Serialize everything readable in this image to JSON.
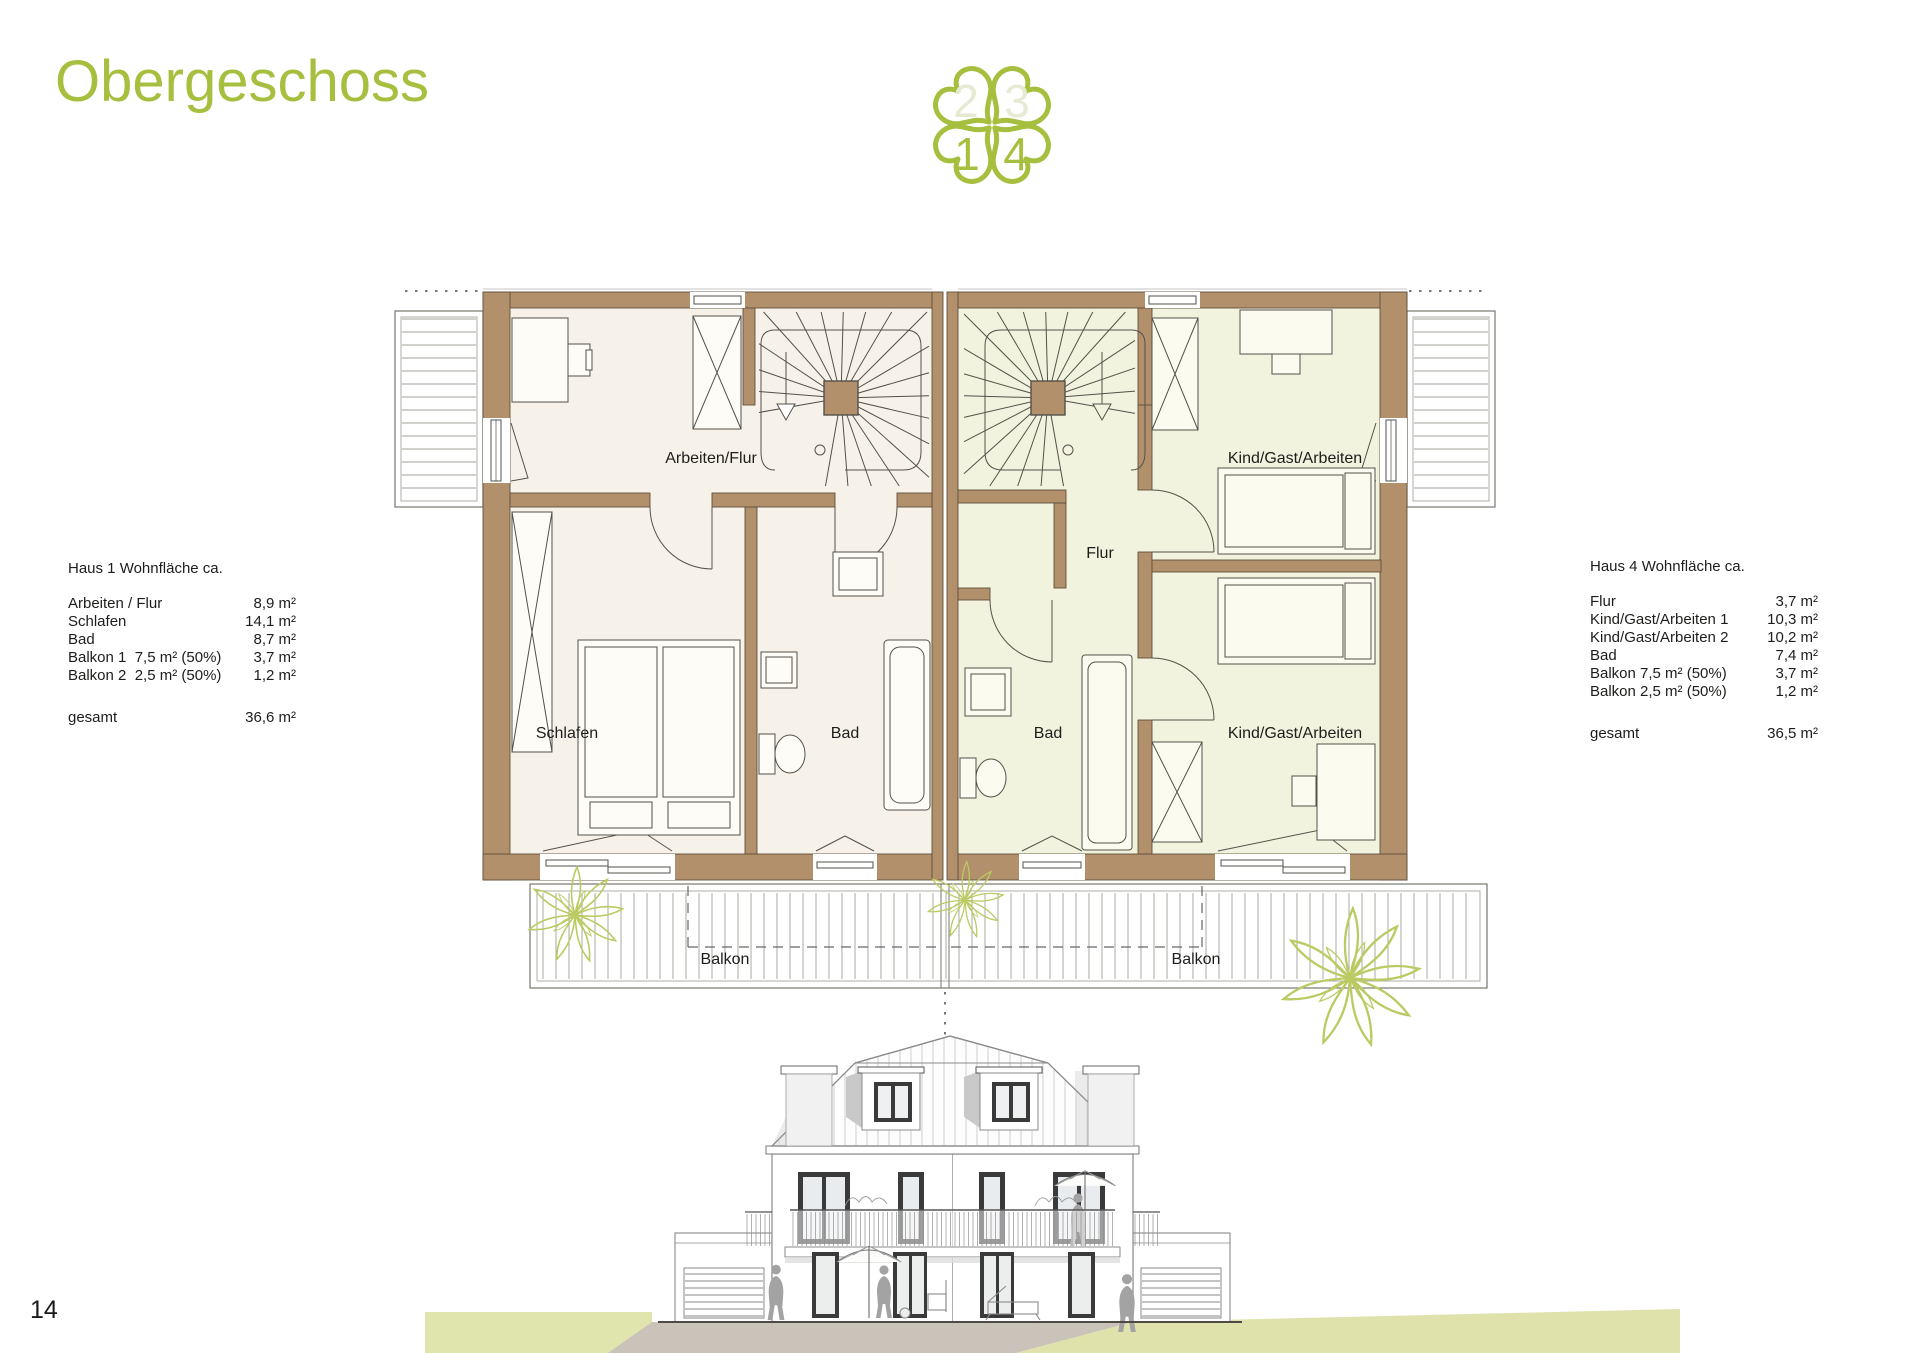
{
  "page": {
    "title": "Obergeschoss",
    "page_number": "14"
  },
  "logo": {
    "top_left": "2",
    "top_right": "3",
    "bottom_left": "1",
    "bottom_right": "4"
  },
  "tables": {
    "haus1": {
      "title": "Haus 1 Wohnfläche ca.",
      "rows": [
        {
          "label": "Arbeiten / Flur",
          "value": "8,9 m²"
        },
        {
          "label": "Schlafen",
          "value": "14,1 m²"
        },
        {
          "label": "Bad",
          "value": "8,7 m²"
        },
        {
          "label": "Balkon 1  7,5 m² (50%)",
          "value": "3,7 m²"
        },
        {
          "label": "Balkon 2  2,5 m² (50%)",
          "value": "1,2 m²"
        }
      ],
      "total_label": "gesamt",
      "total_value": "36,6 m²"
    },
    "haus4": {
      "title": "Haus 4 Wohnfläche ca.",
      "rows": [
        {
          "label": "Flur",
          "value": "3,7 m²"
        },
        {
          "label": "Kind/Gast/Arbeiten 1",
          "value": "10,3 m²"
        },
        {
          "label": "Kind/Gast/Arbeiten 2",
          "value": "10,2 m²"
        },
        {
          "label": "Bad",
          "value": "7,4 m²"
        },
        {
          "label": "Balkon 7,5 m² (50%)",
          "value": "3,7 m²"
        },
        {
          "label": "Balkon 2,5 m² (50%)",
          "value": "1,2 m²"
        }
      ],
      "total_label": "gesamt",
      "total_value": "36,5 m²"
    }
  },
  "plan": {
    "labels": {
      "arbeiten_flur": "Arbeiten/Flur",
      "schlafen": "Schlafen",
      "bad_haus1": "Bad",
      "flur": "Flur",
      "kind_gast_arbeiten_oben": "Kind/Gast/Arbeiten",
      "bad_haus4": "Bad",
      "kind_gast_arbeiten_unten": "Kind/Gast/Arbeiten",
      "balkon_haus1": "Balkon",
      "balkon_haus4": "Balkon"
    }
  },
  "colors": {
    "accent_green": "#a6bf3f",
    "pale_number": "#e8e9d3",
    "wall_brown": "#b2906b",
    "floor_haus1": "#f7f2e9",
    "floor_haus4": "#f2f3de",
    "plant_green": "#bcca63"
  }
}
